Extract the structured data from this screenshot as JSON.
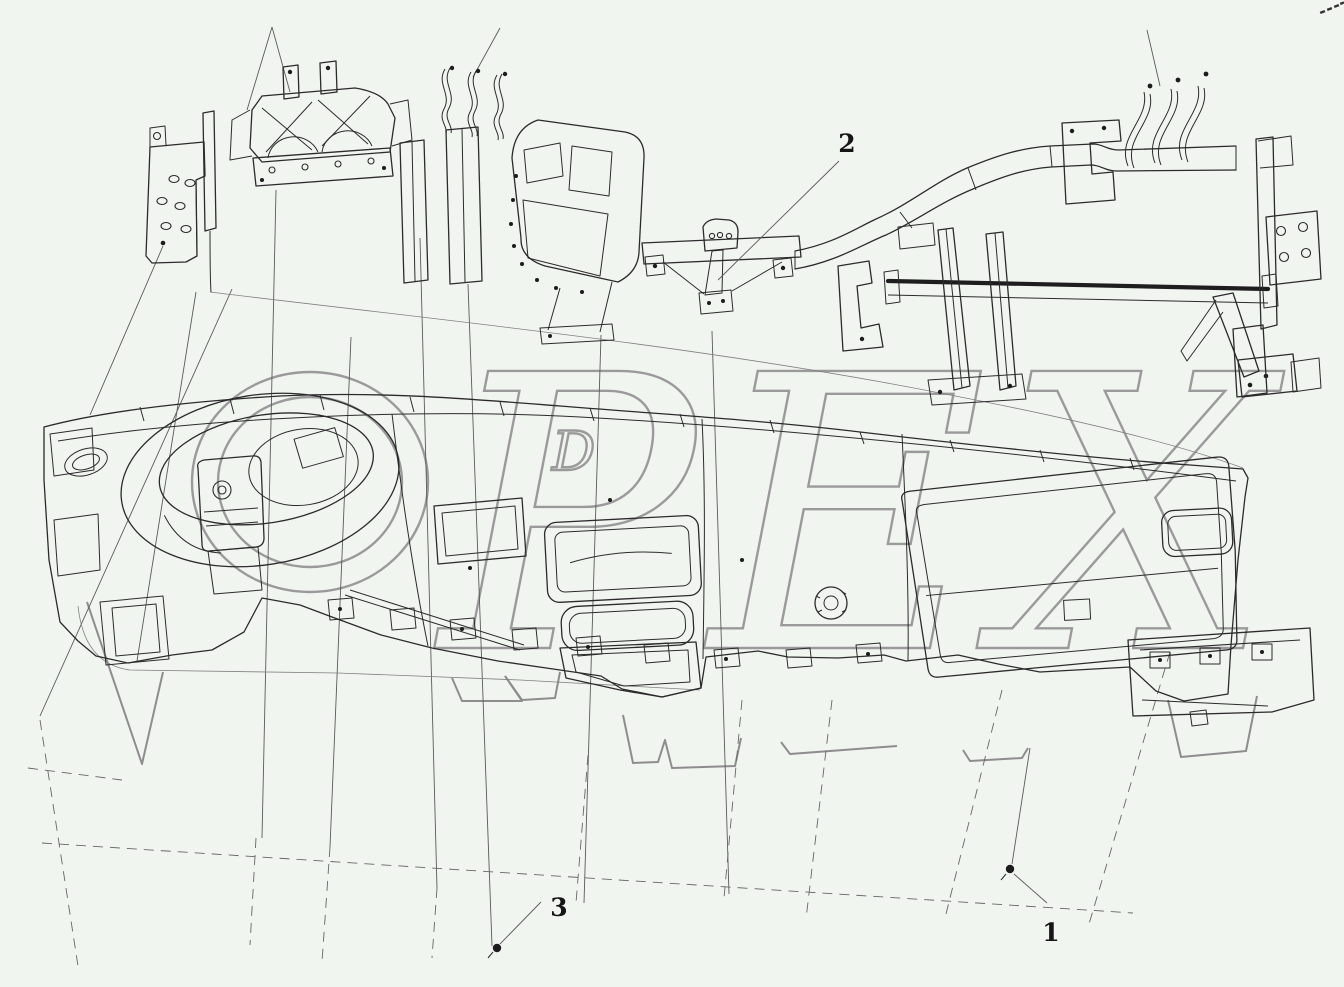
{
  "figure": {
    "kind": "exploded-parts-line-drawing",
    "subject": "instrument-panel-and-cross-beam-assembly"
  },
  "colors": {
    "background": "#f1f5f0",
    "ink": "#2b2b2b",
    "guide_line": "#5a5a5a",
    "watermark": "#9a9a9a",
    "callout_text": "#151515"
  },
  "watermark": {
    "text": "OPEX",
    "letters_pex": "PEX",
    "small_letter": "D"
  },
  "callouts": [
    {
      "label": "2"
    },
    {
      "label": "3"
    },
    {
      "label": "1"
    }
  ]
}
